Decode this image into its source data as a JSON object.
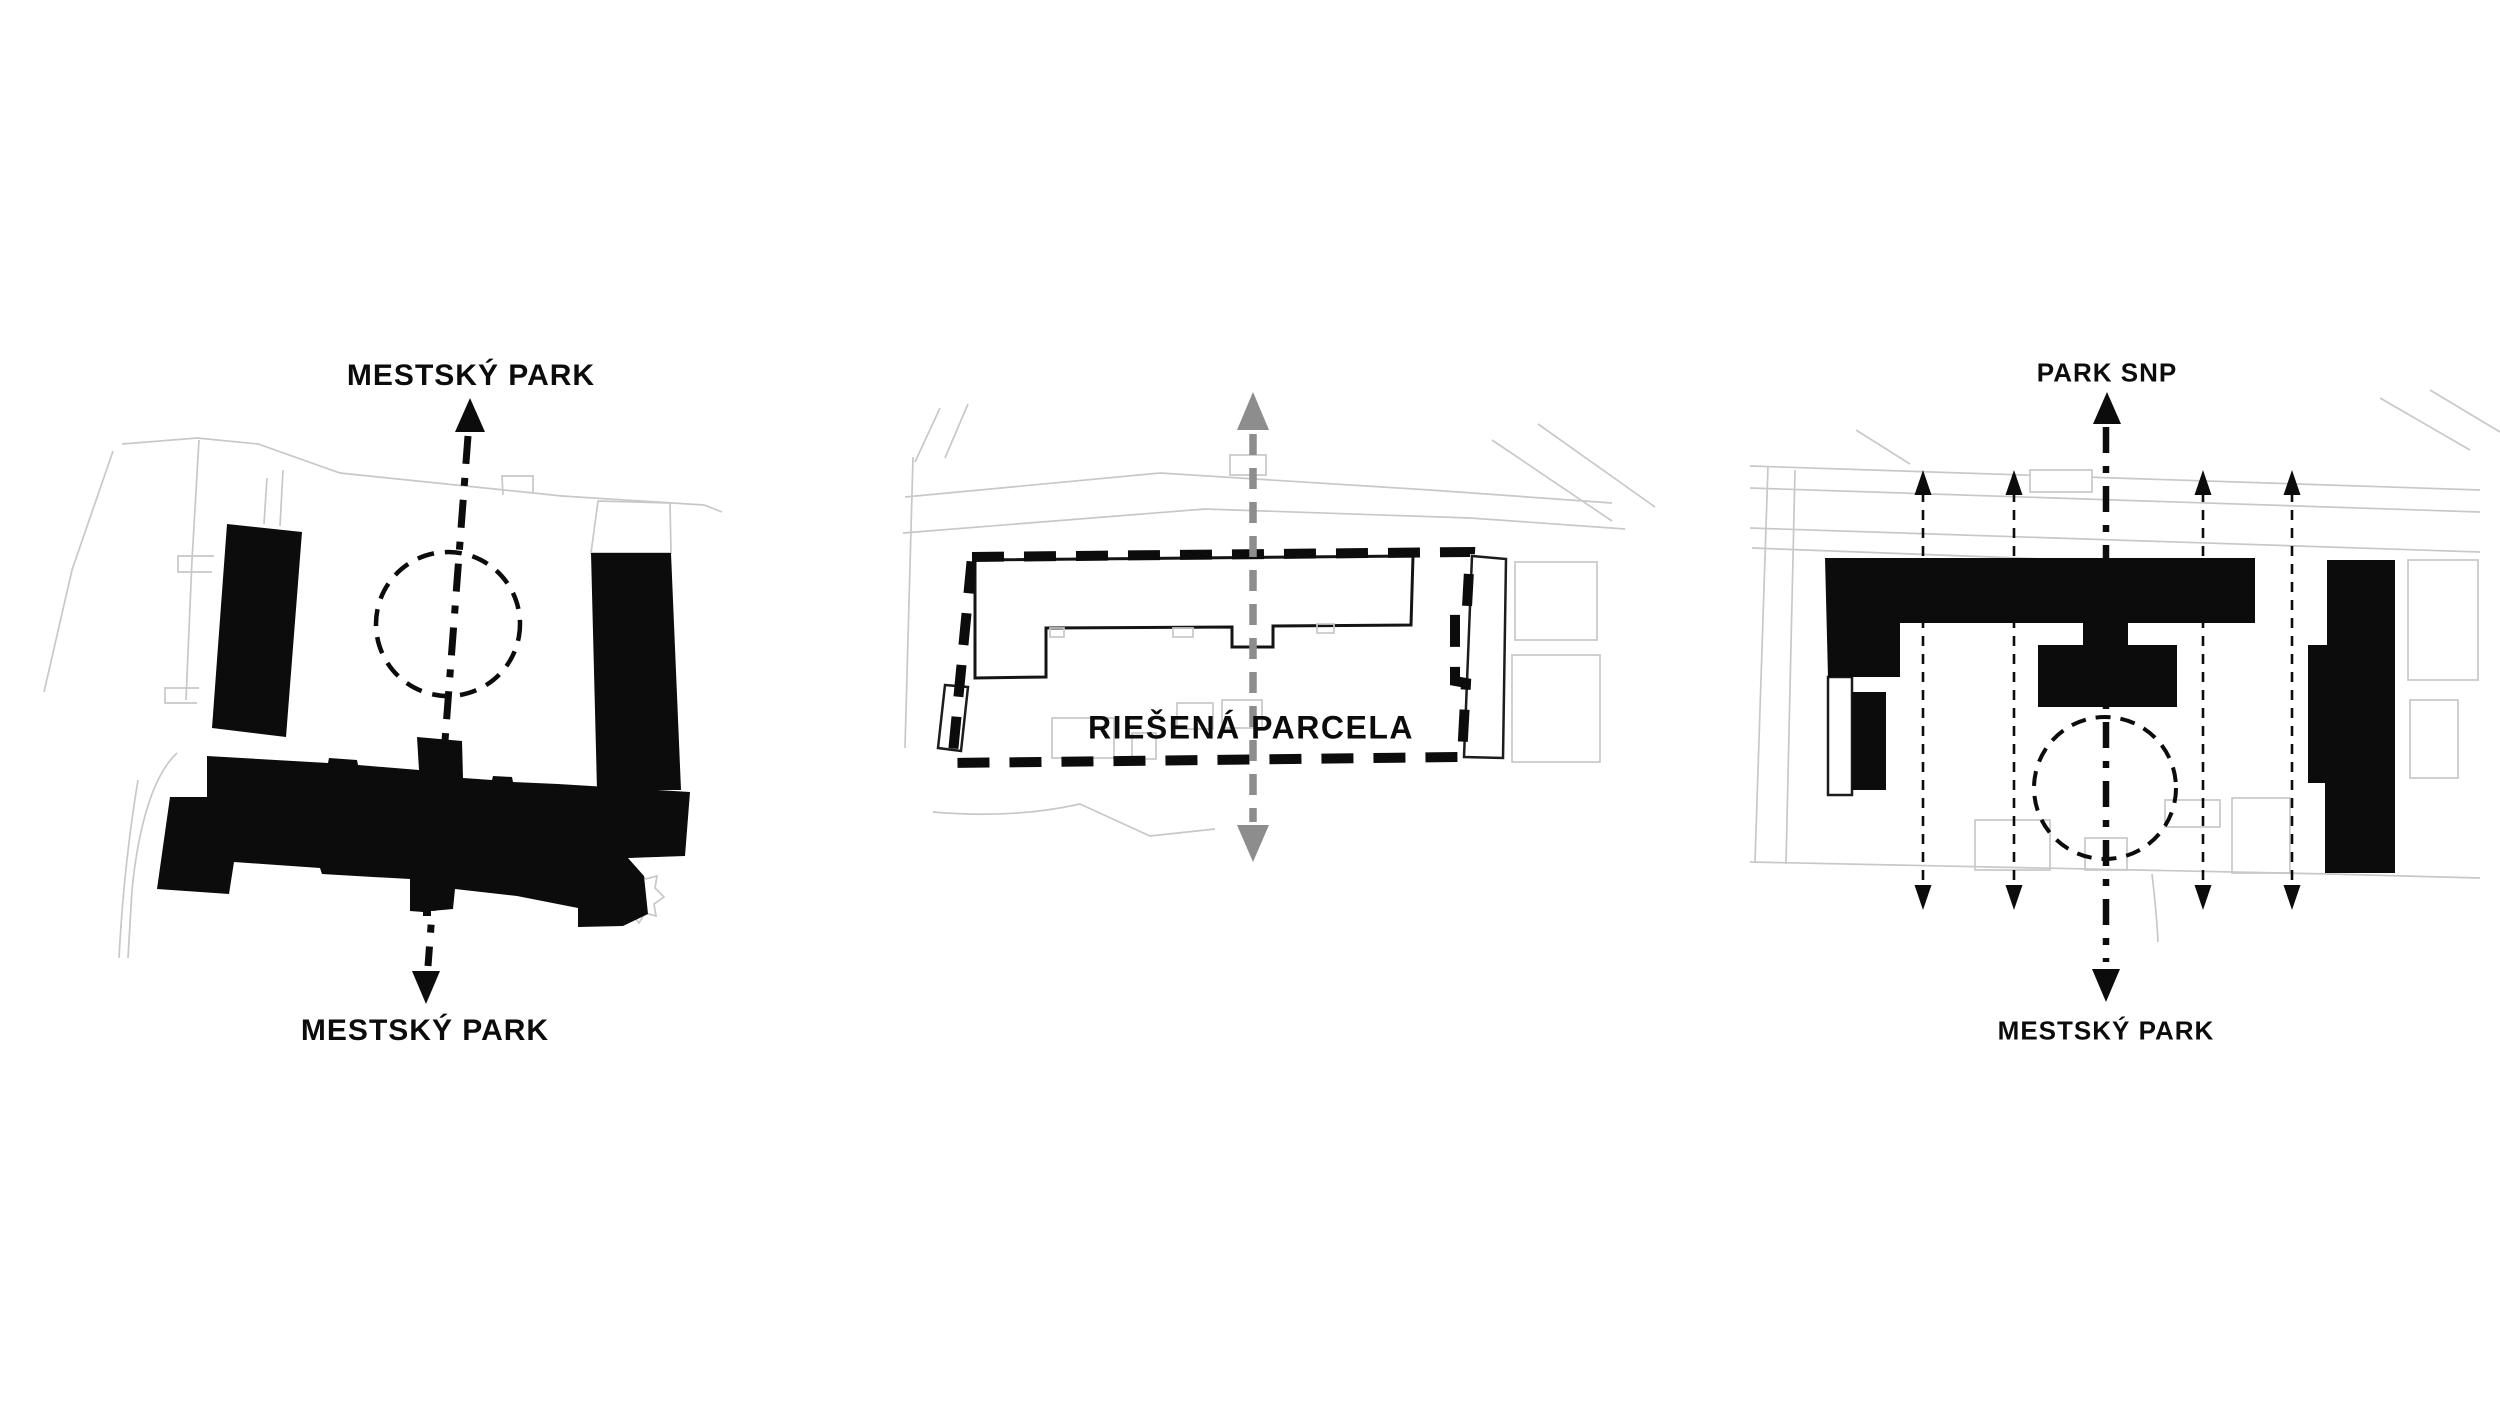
{
  "panels": {
    "left": {
      "label_top": "MESTSKÝ PARK",
      "label_bottom": "MESTSKÝ PARK"
    },
    "middle": {
      "label": "RIEŠENÁ PARCELA"
    },
    "right": {
      "label_top": "PARK SNP",
      "label_bottom": "MESTSKÝ PARK"
    }
  },
  "icons": {
    "axis_arrow_up": "▲",
    "axis_arrow_down": "▼",
    "gray_axis_arrow_up": "▲",
    "gray_axis_arrow_down": "▼",
    "permeability_arrow": "↕",
    "focal_point_circle": "◌"
  },
  "colors": {
    "background": "#ffffff",
    "ink": "#0c0c0c",
    "gray_arrow": "#8d8d8d",
    "map_lines": "#c8c8c8"
  }
}
